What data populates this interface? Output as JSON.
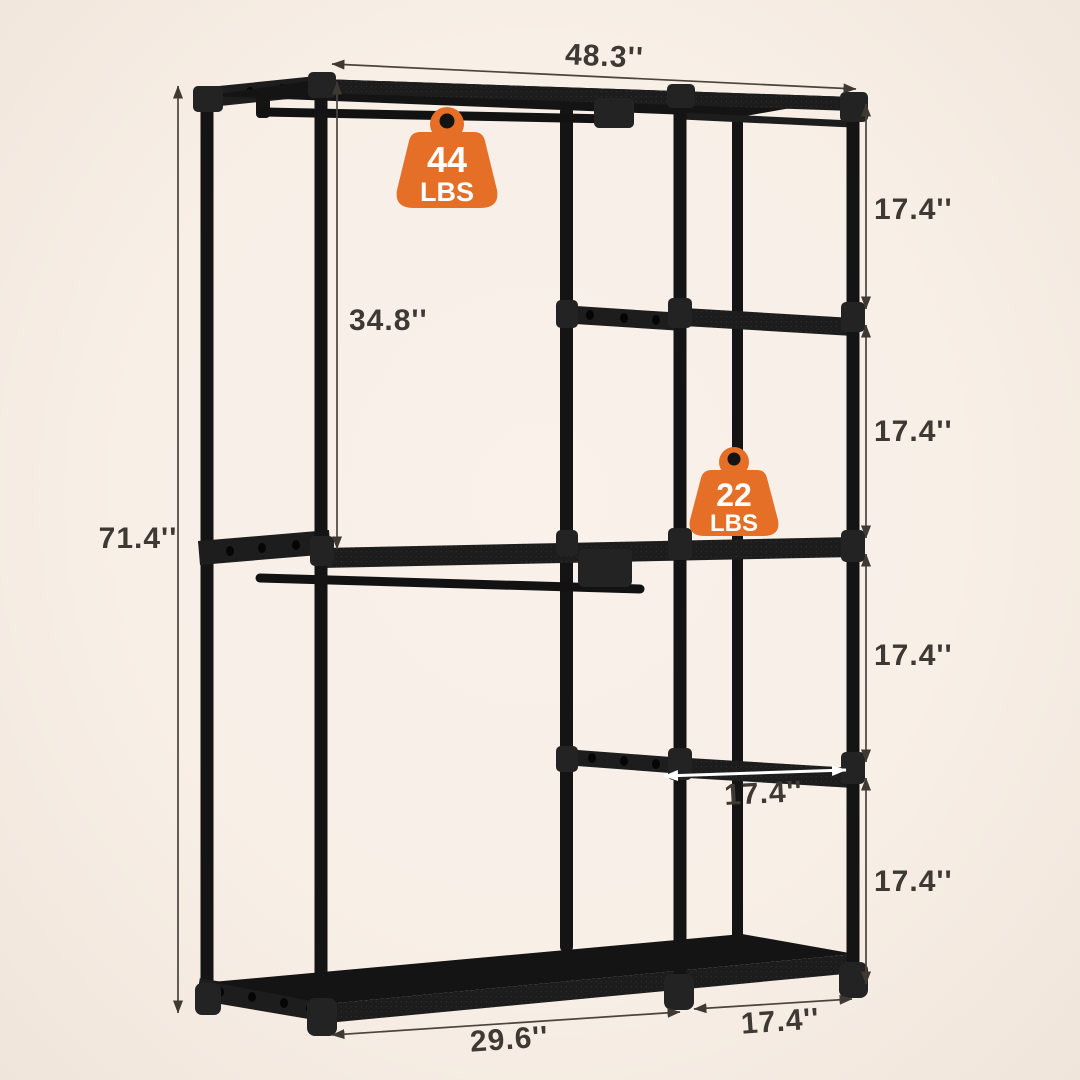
{
  "page": {
    "description": "Product dimension diagram of a black freestanding garment rack closet organizer"
  },
  "colors": {
    "background": "#F8EFE7",
    "rack": "#141414",
    "accent": "#E56F27",
    "dimension_text": "#3E3933",
    "shelf_arrow": "#FFFFFF"
  },
  "dims": {
    "total_width": "48.3''",
    "total_height": "71.4''",
    "hanging_height": "34.8''",
    "tier1": "17.4''",
    "tier2": "17.4''",
    "tier3": "17.4''",
    "tier4": "17.4''",
    "shelf_depth": "17.4''",
    "bottom_left": "29.6''",
    "bottom_right": "17.4''"
  },
  "badges": {
    "top_rod": {
      "value": "44",
      "unit": "LBS"
    },
    "middle_rod": {
      "value": "22",
      "unit": "LBS"
    }
  }
}
